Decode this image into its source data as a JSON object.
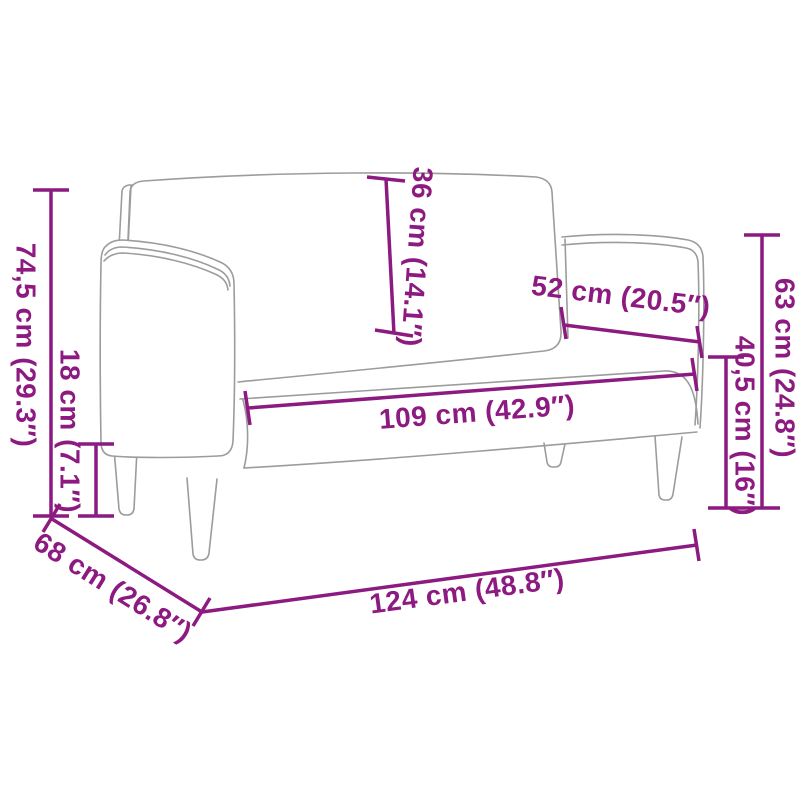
{
  "diagram": {
    "title": "loveseat-sofa-dimension-diagram",
    "colors": {
      "dimension_accent": "#8c1a80",
      "product_outline": "#9c9c9c",
      "background": "#ffffff"
    },
    "dimensions": {
      "overall_height": {
        "label": "74,5 cm (29.3″)",
        "cm": "74,5",
        "inches": "29.3"
      },
      "leg_height": {
        "label": "18 cm (7.1″)",
        "cm": "18",
        "inches": "7.1"
      },
      "backrest_height": {
        "label": "36 cm (14.1″)",
        "cm": "36",
        "inches": "14.1"
      },
      "seat_depth": {
        "label": "52 cm (20.5″)",
        "cm": "52",
        "inches": "20.5"
      },
      "seat_width": {
        "label": "109 cm (42.9″)",
        "cm": "109",
        "inches": "42.9"
      },
      "armrest_height": {
        "label": "63 cm (24.8″)",
        "cm": "63",
        "inches": "24.8"
      },
      "seat_height": {
        "label": "40,5 cm (16″)",
        "cm": "40,5",
        "inches": "16"
      },
      "overall_depth": {
        "label": "68 cm (26.8″)",
        "cm": "68",
        "inches": "26.8"
      },
      "overall_width": {
        "label": "124 cm (48.8″)",
        "cm": "124",
        "inches": "48.8"
      }
    }
  }
}
